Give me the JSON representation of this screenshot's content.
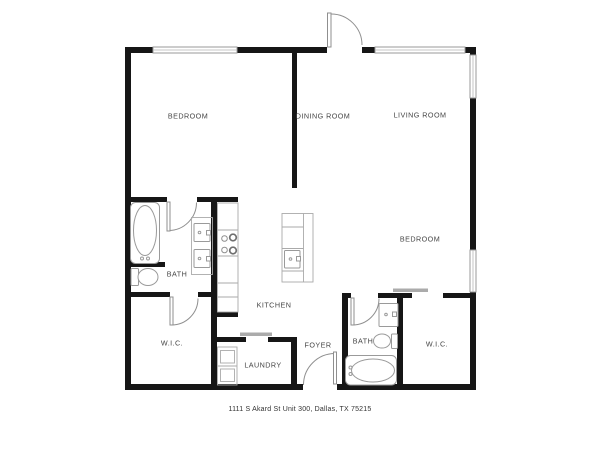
{
  "address": "1111 S Akard St Unit 300, Dallas, TX 75215",
  "rooms": {
    "bedroom1": "BEDROOM",
    "dining_room": "DINING ROOM",
    "living_room": "LIVING ROOM",
    "bedroom2": "BEDROOM",
    "bath1": "BATH",
    "kitchen": "KITCHEN",
    "wic1": "W.I.C.",
    "laundry": "LAUNDRY",
    "foyer": "FOYER",
    "bath2": "BATH",
    "wic2": "W.I.C."
  },
  "colors": {
    "wall": "#161616",
    "fixture_outline": "#9a9a9a",
    "sliding_door": "#ababab",
    "label_text": "#454545",
    "background": "#ffffff"
  }
}
